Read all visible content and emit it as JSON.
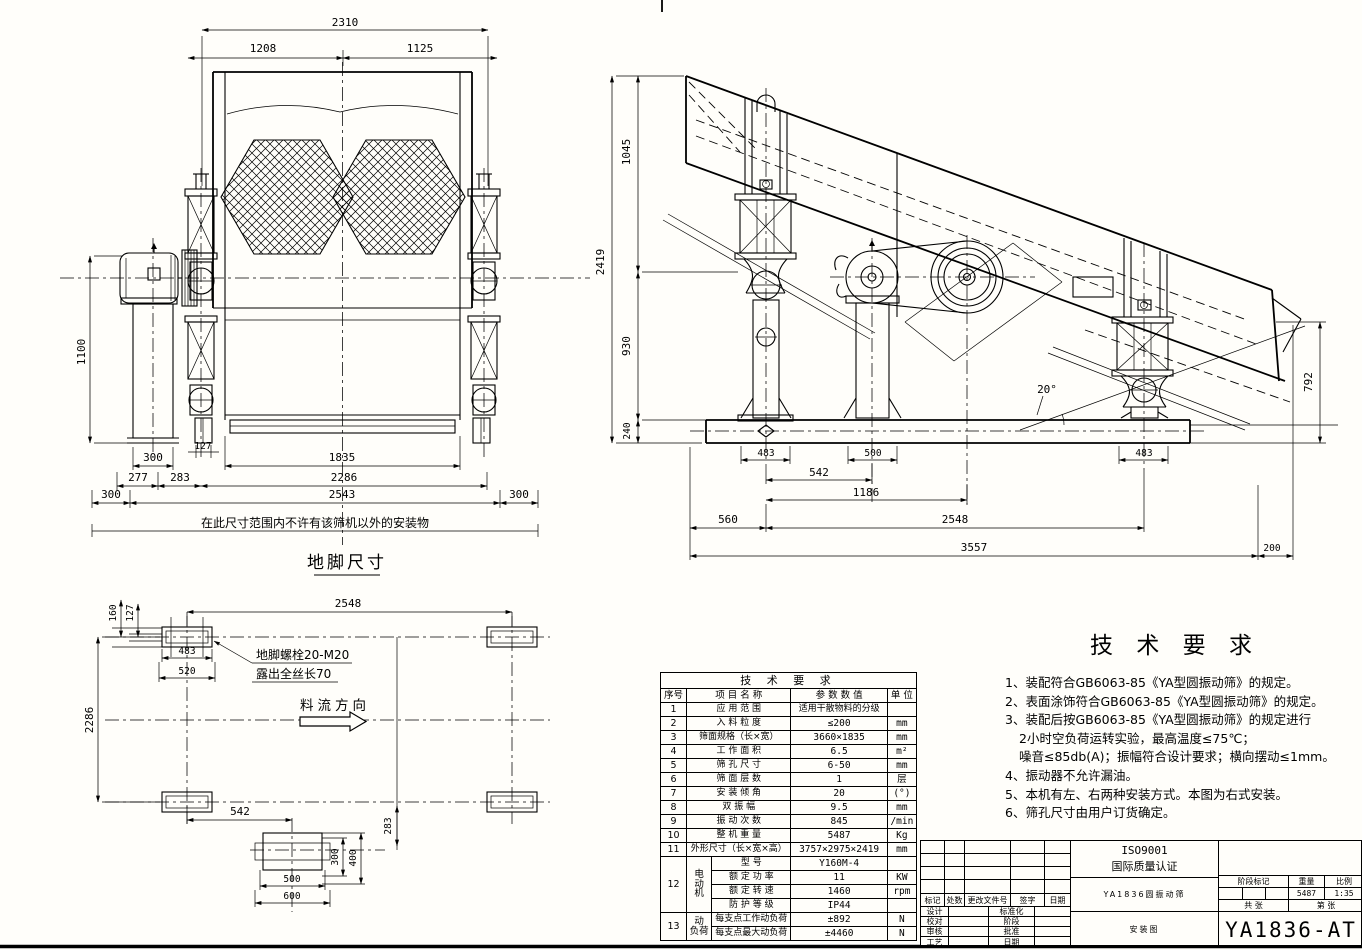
{
  "front": {
    "dims": {
      "w_total": "2310",
      "w_left": "1208",
      "w_right": "1125",
      "h_left": "1100",
      "motor_w": "300",
      "d127": "127",
      "d277": "277",
      "d283": "283",
      "screen_w": "1835",
      "w2286": "2286",
      "w2543": "2543",
      "edge_l": "300",
      "edge_r": "300"
    },
    "note": "在此尺寸范围内不许有该筛机以外的安装物",
    "caption": "地脚尺寸"
  },
  "side": {
    "dims": {
      "h_total": "2419",
      "h1045": "1045",
      "h930": "930",
      "h240": "240",
      "w483l": "483",
      "w500": "500",
      "w542": "542",
      "w1186": "1186",
      "w560": "560",
      "w2548": "2548",
      "w3557": "3557",
      "w483r": "483",
      "h792": "792",
      "w200": "200",
      "angle": "20°"
    }
  },
  "plan": {
    "dims": {
      "w2548": "2548",
      "d160": "160",
      "d127": "127",
      "d483": "483",
      "d520": "520",
      "h2286": "2286",
      "d542": "542",
      "d283": "283",
      "d300": "300",
      "d400": "400",
      "d500": "500",
      "d600": "600"
    },
    "bolt_note1": "地脚螺栓20-M20",
    "bolt_note2": "露出全丝长70",
    "flow": "料流方向"
  },
  "params": {
    "title": "技 术 要 求",
    "headers": [
      "序号",
      "项 目 名 称",
      "参 数 数 值",
      "单 位"
    ],
    "rows": [
      {
        "no": "1",
        "name": "应 用 范 围",
        "value": "适用干散物料的分级",
        "unit": ""
      },
      {
        "no": "2",
        "name": "入 料 粒 度",
        "value": "≤200",
        "unit": "mm"
      },
      {
        "no": "3",
        "name": "筛面规格（长×宽）",
        "value": "3660×1835",
        "unit": "mm"
      },
      {
        "no": "4",
        "name": "工 作 面 积",
        "value": "6.5",
        "unit": "m²"
      },
      {
        "no": "5",
        "name": "筛 孔 尺 寸",
        "value": "6-50",
        "unit": "mm"
      },
      {
        "no": "6",
        "name": "筛 面 层 数",
        "value": "1",
        "unit": "层"
      },
      {
        "no": "7",
        "name": "安 装 倾 角",
        "value": "20",
        "unit": "(°)"
      },
      {
        "no": "8",
        "name": "双 振 幅",
        "value": "9.5",
        "unit": "mm"
      },
      {
        "no": "9",
        "name": "振 动 次 数",
        "value": "845",
        "unit": "/min"
      },
      {
        "no": "10",
        "name": "整 机 重 量",
        "value": "5487",
        "unit": "Kg"
      },
      {
        "no": "11",
        "name": "外形尺寸（长×宽×高）",
        "value": "3757×2975×2419",
        "unit": "mm"
      }
    ],
    "motor": {
      "no": "12",
      "group": "电\n动\n机",
      "rows": [
        {
          "name": "型  号",
          "value": "Y160M-4",
          "unit": ""
        },
        {
          "name": "额 定 功 率",
          "value": "11",
          "unit": "KW"
        },
        {
          "name": "额 定 转 速",
          "value": "1460",
          "unit": "rpm"
        },
        {
          "name": "防 护 等 级",
          "value": "IP44",
          "unit": ""
        }
      ]
    },
    "load": {
      "no": "13",
      "group": "动\n负荷",
      "rows": [
        {
          "name": "每支点工作动负荷",
          "value": "±892",
          "unit": "N"
        },
        {
          "name": "每支点最大动负荷",
          "value": "±4460",
          "unit": "N"
        }
      ]
    }
  },
  "requirements": {
    "title": "技 术 要 求",
    "items": [
      "1、装配符合GB6063-85《YA型圆振动筛》的规定。",
      "2、表面涂饰符合GB6063-85《YA型圆振动筛》的规定。",
      "3、装配后按GB6063-85《YA型圆振动筛》的规定进行",
      "2小时空负荷运转实验，最高温度≤75℃；",
      "噪音≤85db(A)；振幅符合设计要求；横向摆动≤1mm。",
      "4、振动器不允许漏油。",
      "5、本机有左、右两种安装方式。本图为右式安装。",
      "6、筛孔尺寸由用户订货确定。"
    ]
  },
  "titleblock": {
    "iso1": "ISO9001",
    "iso2": "国际质量认证",
    "product": "YA1836圆振动筛",
    "doc_type": "安装图",
    "drawing_no": "YA1836-AT",
    "rev_cols": [
      "标记",
      "处数",
      "更改文件号",
      "签字",
      "日期"
    ],
    "sign_rows": [
      [
        "设计",
        "标准化"
      ],
      [
        "校对",
        "阶段"
      ],
      [
        "审核",
        "批准"
      ],
      [
        "工艺",
        "日期"
      ]
    ],
    "stage_label": "阶段标记",
    "weight_label": "重量",
    "scale_label": "比例",
    "weight": "5487",
    "scale": "1:35",
    "total_label": "共  张",
    "sheet_label": "第  张"
  }
}
